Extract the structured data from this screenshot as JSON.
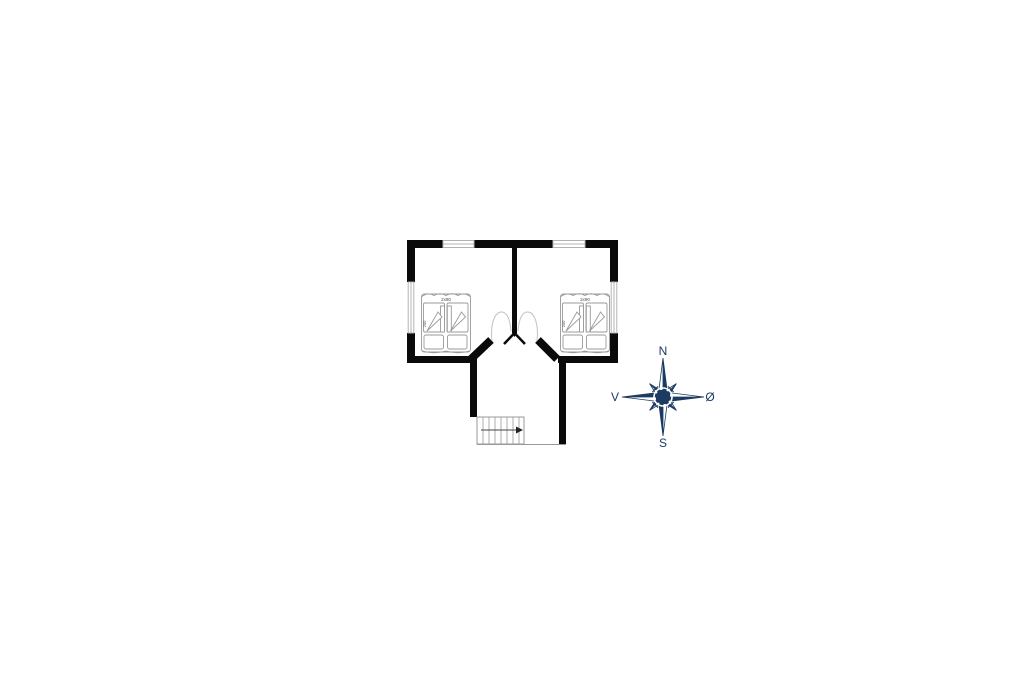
{
  "canvas": {
    "width": 1024,
    "height": 682,
    "background": "#ffffff"
  },
  "floorplan": {
    "title": "first-floor-plan",
    "wall_color": "#0a0a0a",
    "furniture_outline_color": "#999999",
    "window_color": "#b3b3b3",
    "bedrooms": [
      {
        "id": "bedroom-left",
        "bed": {
          "width_label": "2x90",
          "length_label": "200"
        }
      },
      {
        "id": "bedroom-right",
        "bed": {
          "width_label": "2x90",
          "length_label": "200"
        }
      }
    ],
    "stairs": {
      "treads": 8,
      "direction_icon": "arrow-right-icon"
    }
  },
  "compass": {
    "icon": "compass-rose-icon",
    "color": "#1c3b63",
    "labels": {
      "north": "N",
      "south": "S",
      "west": "V",
      "east": "Ø"
    }
  }
}
